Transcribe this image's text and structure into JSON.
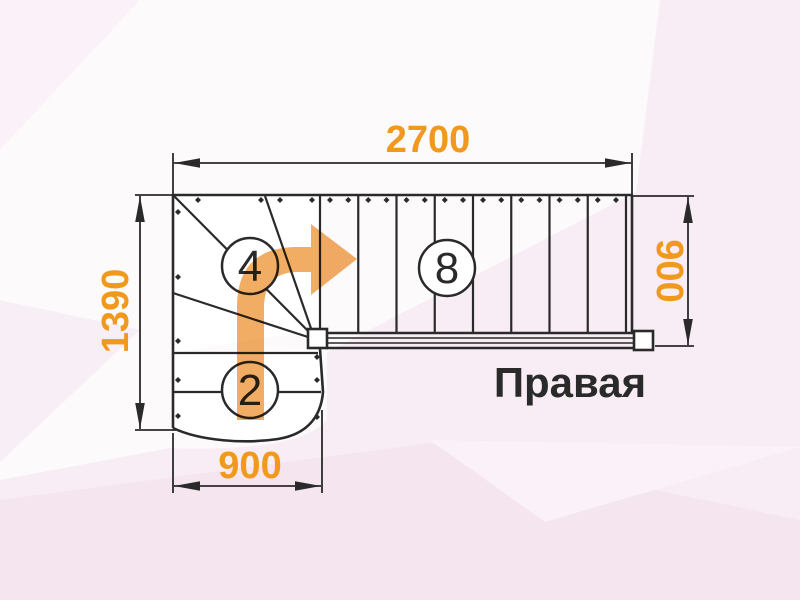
{
  "title": "Правая",
  "dimensions": {
    "top": "2700",
    "left": "1390",
    "right": "900",
    "bottom": "900"
  },
  "steps": {
    "winder": "4",
    "straight_top": "8",
    "straight_bottom": "2"
  },
  "colors": {
    "accent_orange": "#f0991c",
    "arrow_orange": "#f0a24d",
    "line_dark": "#2a2a2a",
    "bg_base": "#fdfafc",
    "bg_pink": "#f8edf4",
    "bg_pink_deep": "#f5e5ee",
    "bg_pink_light": "#faf2f8",
    "stair_fill": "#ffffff"
  }
}
